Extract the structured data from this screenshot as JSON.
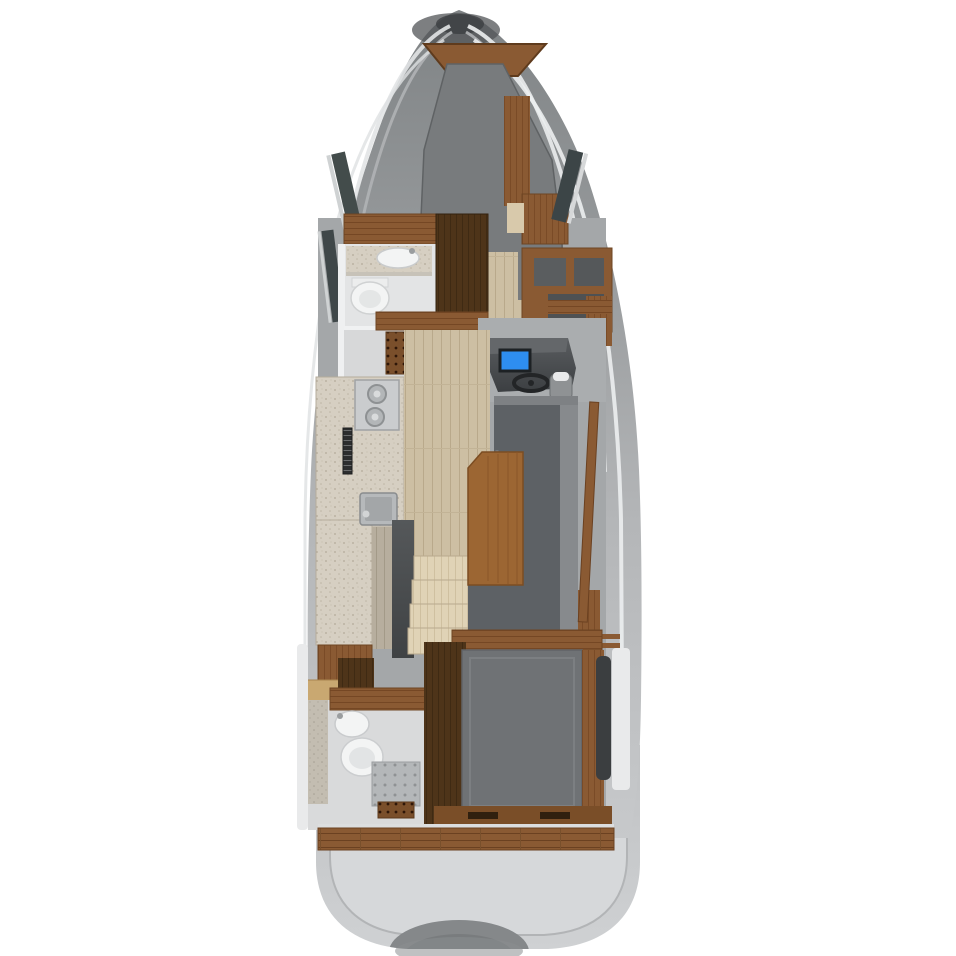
{
  "scene": {
    "title": "Motor yacht lower-deck floor plan, top-down 3D render",
    "type": "boat-floorplan-render",
    "view": "top-down",
    "background": "#ffffff"
  },
  "colors": {
    "hull_top": "#7f8385",
    "hull_mid": "#a7aaac",
    "hull_bottom": "#c7c9cb",
    "sheer_highlight": "#e9ebec",
    "platform": "#c6c8ca",
    "platform_inner": "#d6d8da",
    "tender_shadow": "#85888a",
    "apex_shadow": "#515457",
    "room_base": "#a4a7a9",
    "mattress_fwd": "#787b7d",
    "mattress_aft": "#6f7275",
    "bed_base_wood": "#4f361f",
    "sofa": "#5d6165",
    "sofa_backrest": "#878a8d",
    "table_wood": "#9c6633",
    "wood": "#8a5a33",
    "wood_dark": "#4e3419",
    "wood_light": "#c9a871",
    "teak": "#8a5a33",
    "floor_plank": "#cdbfa3",
    "floor_plank_muted": "#b7ae9e",
    "step_wood": "#e0d3b6",
    "counter_speckle": "#d6cfc2",
    "steel": "#c0c3c5",
    "fixture_white": "#f3f4f4",
    "room_white": "#e3e4e5",
    "shower_floor": "#d7d8d9",
    "console_dark": "#46494c",
    "screen_blue": "#2e8ef0",
    "wheel_black": "#232527",
    "window_dark": "#3c4547",
    "void_dark": "#4a4d4f",
    "helm_floor": "#aaadaf",
    "tile_gray": "#b4b7b9",
    "grate_wood": "#7a4f2b",
    "vent_dark": "#2c2d2e",
    "aft_room_floor": "#d9dadb",
    "hull_white_band": "#e9eaeb"
  },
  "vessel": {
    "areas": [
      {
        "id": "bow-cabin",
        "label": "Forward cabin with V-berth",
        "objects": [
          "double-berth",
          "bow-shelf",
          "side-cabinet",
          "hull-windows"
        ]
      },
      {
        "id": "forward-bathroom",
        "label": "Forward head",
        "objects": [
          "vanity-sink",
          "toilet",
          "shower-grate"
        ]
      },
      {
        "id": "wardrobe",
        "label": "Wardrobe closet",
        "objects": [
          "dark-wood-cabinet"
        ]
      },
      {
        "id": "helm-station",
        "label": "Helm station",
        "objects": [
          "chartplotter-screen",
          "steering-wheel",
          "helm-seat",
          "nav-shelving"
        ]
      },
      {
        "id": "galley",
        "label": "Galley",
        "objects": [
          "two-burner-stove",
          "galley-sink",
          "vent-grille",
          "speckled-countertop"
        ]
      },
      {
        "id": "salon-dinette",
        "label": "Salon dinette",
        "objects": [
          "dining-table",
          "u-shaped-sofa",
          "side-deck-trim"
        ]
      },
      {
        "id": "companionway-stairs",
        "label": "Companionway stairs",
        "steps": 4
      },
      {
        "id": "aft-bathroom",
        "label": "Aft head",
        "objects": [
          "sink",
          "toilet",
          "tiled-shower",
          "teak-grate"
        ]
      },
      {
        "id": "aft-cabin",
        "label": "Aft cabin",
        "objects": [
          "double-berth",
          "wood-floor-surround",
          "transom-lockers"
        ]
      },
      {
        "id": "cockpit",
        "label": "Cockpit teak step",
        "objects": [
          "teak-plank-step",
          "locker-handles"
        ]
      },
      {
        "id": "swim-platform",
        "label": "Swim platform",
        "objects": [
          "tender-recess"
        ]
      }
    ]
  }
}
